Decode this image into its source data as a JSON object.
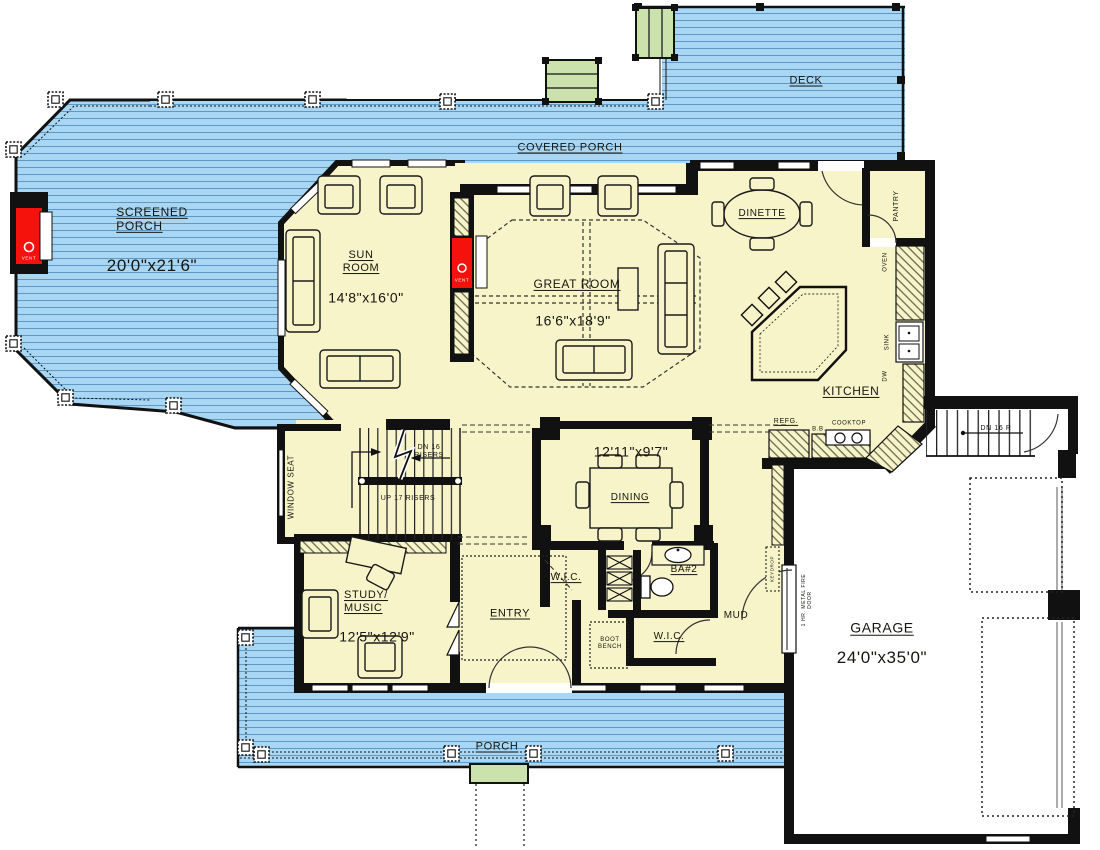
{
  "colors": {
    "porch_blue": "#A9D6F3",
    "porch_board_line": "#5E98C5",
    "room_cream": "#F8F4C9",
    "step_green": "#CBE2AC",
    "fireplace_red": "#F5120D",
    "wall_black": "#111111"
  },
  "areas": {
    "screened_porch": {
      "label": "SCREENED\nPORCH",
      "dims": "20'0\"x21'6\""
    },
    "covered_porch": {
      "label": "COVERED PORCH"
    },
    "deck": {
      "label": "DECK"
    },
    "porch": {
      "label": "PORCH"
    },
    "sun_room": {
      "label": "SUN\nROOM",
      "dims": "14'8\"x16'0\""
    },
    "great_room": {
      "label": "GREAT ROOM",
      "dims": "16'6\"x18'9\""
    },
    "dinette": {
      "label": "DINETTE"
    },
    "kitchen": {
      "label": "KITCHEN"
    },
    "pantry": {
      "label": "PANTRY"
    },
    "dining": {
      "label": "DINING",
      "dims": "12'11\"x9'7\""
    },
    "study": {
      "label": "STUDY/\nMUSIC",
      "dims": "12'5\"x12'9\""
    },
    "entry": {
      "label": "ENTRY"
    },
    "wic1": {
      "label": "W.I.C."
    },
    "wic2": {
      "label": "W.I.C."
    },
    "bath2": {
      "label": "BA#2"
    },
    "mud": {
      "label": "MUD"
    },
    "garage": {
      "label": "GARAGE",
      "dims": "24'0\"x35'0\""
    }
  },
  "stairs": {
    "main_dn": "DN 16\nRISERS",
    "main_up": "UP 17 RISERS",
    "garage_dn": "DN 16 R"
  },
  "fixtures": {
    "refg": "REFG.",
    "bb": "B.B.",
    "cooktop": "COOKTOP",
    "oven": "OVEN",
    "sink": "SINK",
    "dw": "DW",
    "window_seat": "WINDOW SEAT",
    "boot_bench": "BOOT\nBENCH",
    "shelves": "SHRD",
    "keydrop": "KEYDROP",
    "fire_door": "1 HR. METAL FIRE\nDOOR",
    "vent": "VENT"
  }
}
